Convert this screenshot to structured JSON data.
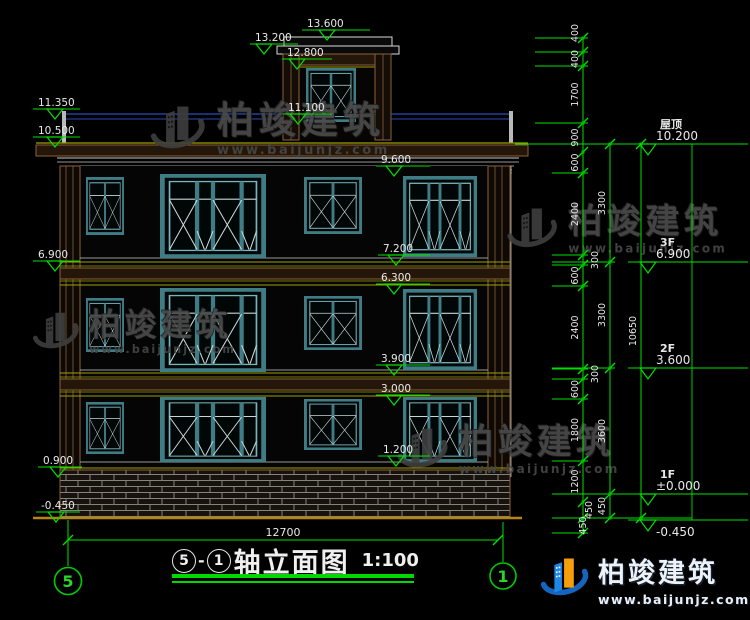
{
  "drawing": {
    "title": {
      "axis_from": "5",
      "dash": "-",
      "axis_to": "1",
      "name": "轴立面图",
      "scale": "1:100"
    },
    "axis_bubbles": {
      "left": "5",
      "right": "1"
    },
    "levels": [
      {
        "label": "屋顶",
        "value": "10.200"
      },
      {
        "label": "3F",
        "value": "6.900"
      },
      {
        "label": "2F",
        "value": "3.600"
      },
      {
        "label": "1F",
        "value": "±0.000"
      },
      {
        "label": "",
        "value": "-0.450"
      }
    ],
    "elevations": {
      "left": [
        "11.350",
        "10.500",
        "6.900",
        "0.900",
        "-0.450"
      ],
      "top": [
        "13.600",
        "13.200",
        "12.800",
        "11.100"
      ],
      "mid": [
        "9.600",
        "7.200",
        "6.300",
        "3.900",
        "3.000",
        "1.200"
      ]
    },
    "dims": {
      "detail": [
        "400",
        "400",
        "1700",
        "900",
        "600",
        "2400",
        "300",
        "600",
        "2400",
        "300",
        "600",
        "1800",
        "1200",
        "450",
        "450"
      ],
      "story": [
        "3300",
        "3300",
        "3600",
        "450"
      ],
      "overall": [
        "10650"
      ],
      "width": "12700"
    }
  },
  "watermark": {
    "brand": "柏竣建筑",
    "site": "www.baijunjz.com"
  },
  "footer_logo": {
    "brand": "柏竣建筑",
    "site": "www.baijunjz.com"
  },
  "colors": {
    "dim_green": "#00e000",
    "text_white": "#e8e8e8",
    "wall_brown": "#8a6239",
    "window_teal": "#3f7d86",
    "railing_blue": "#2b4db8",
    "logo_blue": "#1e88e5",
    "logo_orange": "#f59e0b"
  }
}
